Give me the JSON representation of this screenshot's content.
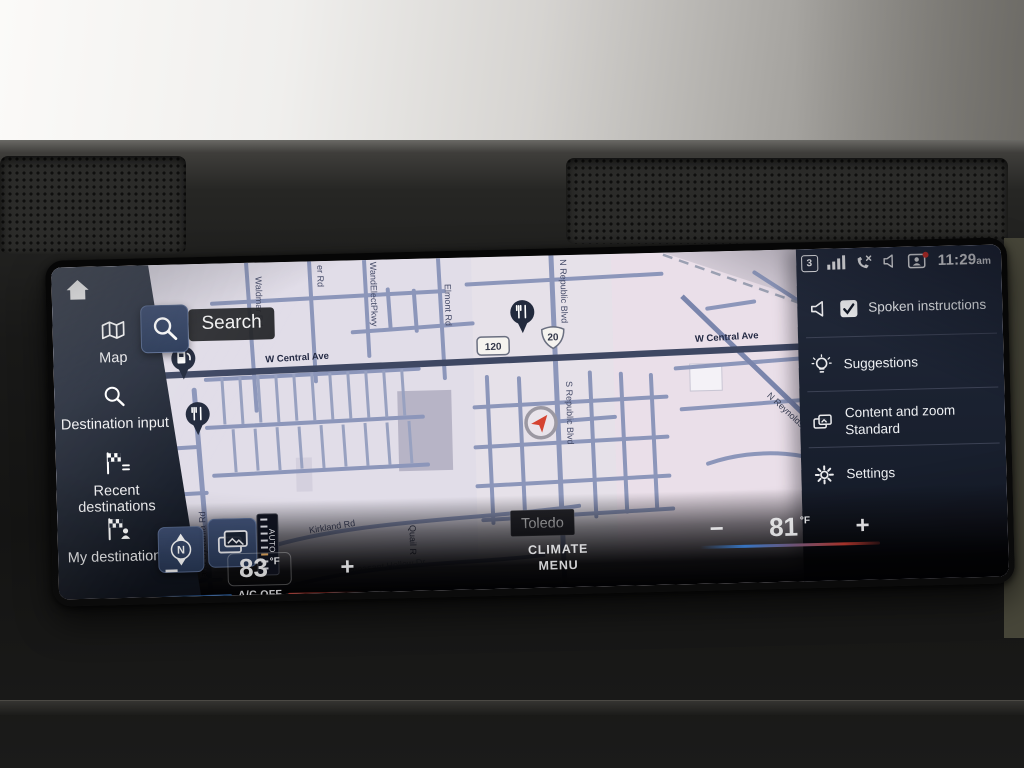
{
  "status_bar": {
    "network_badge": "3",
    "time": "11:29",
    "time_suffix": "am"
  },
  "sidebar": {
    "items": [
      {
        "id": "map",
        "label": "Map"
      },
      {
        "id": "destination-input",
        "label": "Destination input"
      },
      {
        "id": "recent-destinations",
        "label": "Recent destinations"
      },
      {
        "id": "my-destinations",
        "label": "My destinations"
      }
    ]
  },
  "map": {
    "search_label": "Search",
    "city_label": "Toledo",
    "compass": "N",
    "zoom_scale": "AUTO",
    "route_shields": {
      "state": "120",
      "us": "20"
    },
    "streets": {
      "central_ave": "W Central Ave",
      "waldmar": "Waldmar Rd",
      "er": "er Rd",
      "pkwy": "WandElectPkwy",
      "elmont": "Elmont Rd",
      "n_republic": "N Republic Blvd",
      "s_republic": "S Republic Blvd",
      "holland_sylvania": "land Sylvania Rd",
      "n_reynolds": "N Reynolds Rd",
      "kirkland": "Kirkland Rd",
      "pheasant": "Pheasant Hollow Dr",
      "quail": "Quail R"
    }
  },
  "right_panel": {
    "items": [
      {
        "id": "spoken-instructions",
        "label": "Spoken instructions",
        "checked": true
      },
      {
        "id": "suggestions",
        "label": "Suggestions"
      },
      {
        "id": "content-and-zoom",
        "label": "Content and zoom",
        "value": "Standard"
      },
      {
        "id": "settings",
        "label": "Settings"
      }
    ]
  },
  "climate": {
    "minus": "−",
    "plus": "+",
    "driver": {
      "temp": "83",
      "unit": "°F",
      "status": "A/C OFF"
    },
    "passenger": {
      "temp": "81",
      "unit": "°F"
    },
    "menu_label_line1": "CLIMATE",
    "menu_label_line2": "MENU"
  },
  "colors": {
    "accent_blue": "#3f86df",
    "accent_red": "#c03a30",
    "map_background": "#e6e1e9",
    "panel_background": "#1b2231",
    "road_minor": "#8c96ba",
    "road_major": "#3e4762"
  }
}
